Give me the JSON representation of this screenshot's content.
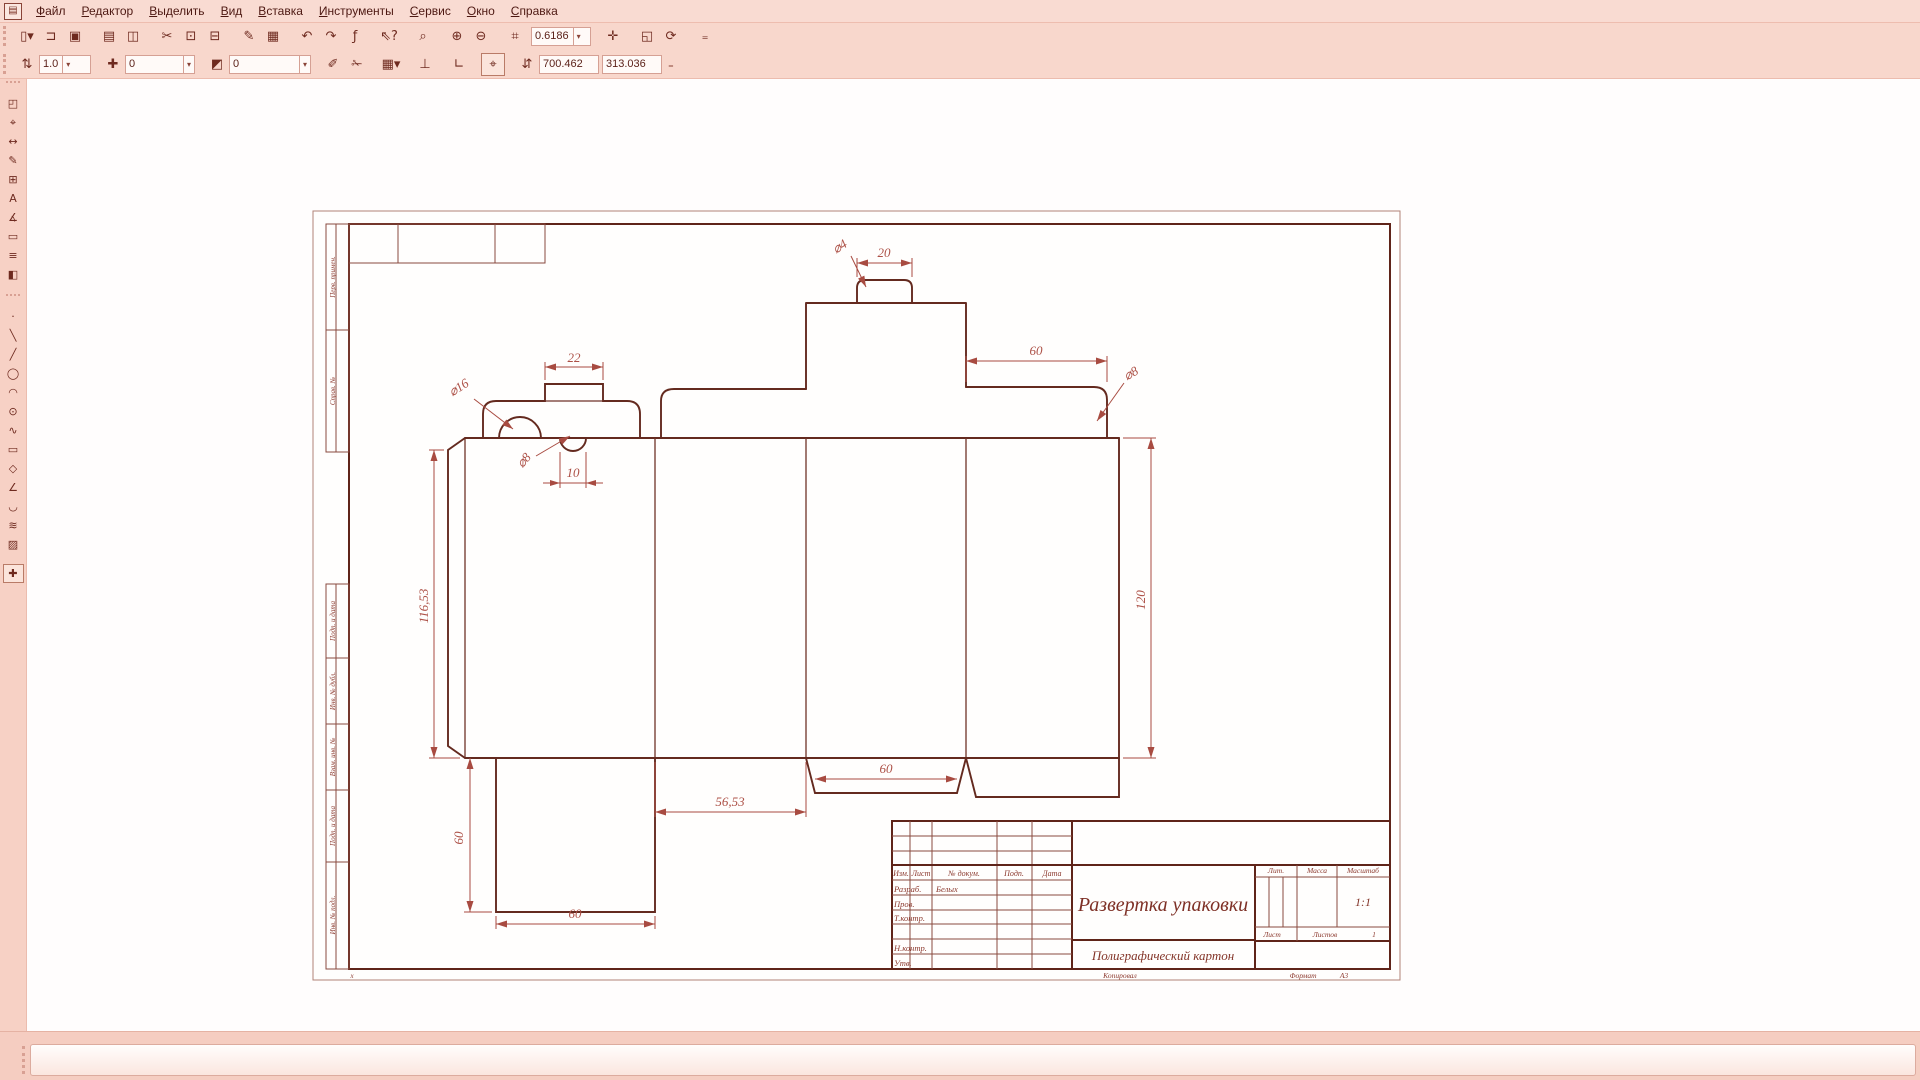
{
  "chrome": {
    "app_icon_glyph": "▤"
  },
  "menu": {
    "items": [
      {
        "name": "menu-file",
        "label": "Файл"
      },
      {
        "name": "menu-editor",
        "label": "Редактор"
      },
      {
        "name": "menu-select",
        "label": "Выделить"
      },
      {
        "name": "menu-view",
        "label": "Вид"
      },
      {
        "name": "menu-insert",
        "label": "Вставка"
      },
      {
        "name": "menu-tools",
        "label": "Инструменты"
      },
      {
        "name": "menu-service",
        "label": "Сервис"
      },
      {
        "name": "menu-window",
        "label": "Окно"
      },
      {
        "name": "menu-help",
        "label": "Справка"
      }
    ]
  },
  "toolbar_top": {
    "icons_left": [
      {
        "name": "new-document-icon",
        "glyph": "▯▾"
      },
      {
        "name": "open-icon",
        "glyph": "⊐"
      },
      {
        "name": "save-icon",
        "glyph": "▣"
      },
      {
        "name": "print-preview-icon",
        "glyph": "▤",
        "cls": "sep"
      },
      {
        "name": "page-layout-icon",
        "glyph": "◫"
      },
      {
        "name": "cut-icon",
        "glyph": "✂",
        "cls": "sep"
      },
      {
        "name": "copy-icon",
        "glyph": "⊡"
      },
      {
        "name": "paste-icon",
        "glyph": "⊟"
      },
      {
        "name": "copy-style-icon",
        "glyph": "✎",
        "cls": "sep"
      },
      {
        "name": "table-icon",
        "glyph": "▦"
      },
      {
        "name": "undo-icon",
        "glyph": "↶",
        "cls": "sep"
      },
      {
        "name": "redo-icon",
        "glyph": "↷"
      },
      {
        "name": "variables-icon",
        "glyph": "ƒ"
      },
      {
        "name": "context-help-icon",
        "glyph": "⇖?",
        "cls": "sep"
      },
      {
        "name": "zoom-selection-icon",
        "glyph": "⌕",
        "cls": "sep"
      },
      {
        "name": "zoom-in-icon",
        "glyph": "⊕",
        "cls": "sep"
      },
      {
        "name": "zoom-out-icon",
        "glyph": "⊖"
      },
      {
        "name": "zoom-area-icon",
        "glyph": "⌗",
        "cls": "sep"
      }
    ],
    "scale_value": "0.6186",
    "icons_right": [
      {
        "name": "pan-icon",
        "glyph": "✛",
        "cls": "sep"
      },
      {
        "name": "show-page-icon",
        "glyph": "◱",
        "cls": "sep"
      },
      {
        "name": "rebuild-view-icon",
        "glyph": "⟳"
      },
      {
        "name": "toolbar-overflow-icon",
        "glyph": "₌",
        "cls": "sep"
      }
    ]
  },
  "toolbar_params": {
    "line_style_icon": "⇅",
    "lineweight_value": "1.0",
    "layer_icon": "✚",
    "layer_value": "0",
    "style_icon": "◩",
    "style_value": "0",
    "icons": [
      {
        "name": "eraser-icon",
        "glyph": "✐",
        "cls": "sep"
      },
      {
        "name": "trim-icon",
        "glyph": "✁"
      },
      {
        "name": "grid-icon",
        "glyph": "▦▾",
        "cls": "sep"
      },
      {
        "name": "local-axes-icon",
        "glyph": "⊥",
        "cls": "sep"
      },
      {
        "name": "corner-snap-icon",
        "glyph": "∟",
        "cls": "sep"
      },
      {
        "name": "snap-settings-icon",
        "glyph": "⌖",
        "cls": "sep",
        "state": "active"
      }
    ],
    "coords_icon": "⇵",
    "x_value": "700.462",
    "y_value": "313.036",
    "overflow_glyph": "₌"
  },
  "left_toolbar": {
    "groups": [
      {
        "items": [
          {
            "name": "panel-properties",
            "glyph": "◰"
          },
          {
            "name": "panel-geometry",
            "glyph": "⌖"
          },
          {
            "name": "panel-dimensions",
            "glyph": "↔"
          },
          {
            "name": "panel-designations",
            "glyph": "✎"
          },
          {
            "name": "panel-editing",
            "glyph": "⊞"
          },
          {
            "name": "panel-parametrization",
            "glyph": "A"
          },
          {
            "name": "panel-measurement",
            "glyph": "∡"
          },
          {
            "name": "panel-selection",
            "glyph": "▭"
          },
          {
            "name": "panel-specification",
            "glyph": "≡"
          },
          {
            "name": "panel-reports",
            "glyph": "◧"
          }
        ]
      },
      {
        "items": [
          {
            "name": "point-tool",
            "glyph": "·"
          },
          {
            "name": "auxiliary-line-tool",
            "glyph": "╲"
          },
          {
            "name": "segment-tool",
            "glyph": "╱"
          },
          {
            "name": "circle-tool",
            "glyph": "◯"
          },
          {
            "name": "arc-tool",
            "glyph": "◠"
          },
          {
            "name": "ellipse-tool",
            "glyph": "⊙"
          },
          {
            "name": "spline-tool",
            "glyph": "∿"
          },
          {
            "name": "rectangle-tool",
            "glyph": "▭"
          },
          {
            "name": "polygon-tool",
            "glyph": "◇"
          },
          {
            "name": "chamfer-tool",
            "glyph": "∠"
          },
          {
            "name": "fillet-tool",
            "glyph": "◡"
          },
          {
            "name": "offset-tool",
            "glyph": "≋"
          },
          {
            "name": "hatch-tool",
            "glyph": "▨"
          }
        ]
      },
      {
        "items": [
          {
            "name": "continuous-input-tool",
            "glyph": "✚",
            "state": "active"
          }
        ]
      }
    ]
  },
  "drawing": {
    "frame_labels": [
      "Перв. примен.",
      "Справ. №",
      "Подп. и дата",
      "Инв. № дубл.",
      "Взам. инв. №",
      "Подп. и дата",
      "Инв. № подл."
    ],
    "origin_marker": "x",
    "dims": {
      "tab_width": "20",
      "tab_corner": "⌀4",
      "small_tab_width": "22",
      "notch_large": "⌀16",
      "notch_small": "⌀8",
      "notch_offset": "10",
      "top_flap_width": "60",
      "corner_right": "⌀8",
      "body_height": "120",
      "glue_flap_height": "116,53",
      "left_flap_height": "60",
      "panel_width": "56,53",
      "center_flap_width": "60",
      "left_flap_width": "60"
    },
    "title_block": {
      "header_cols": [
        "Изм.",
        "Лист",
        "№ докум.",
        "Подп.",
        "Дата"
      ],
      "rows": [
        {
          "role": "Разраб.",
          "name": "Белых"
        },
        {
          "role": "Пров.",
          "name": ""
        },
        {
          "role": "Т.контр.",
          "name": ""
        },
        {
          "role": "Н.контр.",
          "name": ""
        },
        {
          "role": "Утв.",
          "name": ""
        }
      ],
      "title": "Развертка упаковки",
      "material": "Полиграфический картон",
      "lit_label": "Лит.",
      "mass_label": "Масса",
      "scale_label": "Масштаб",
      "scale_value": "1:1",
      "sheet_label": "Лист",
      "sheets_label": "Листов",
      "sheets_value": "1",
      "copied_label": "Копировал",
      "format_label": "Формат",
      "format_value": "A3"
    }
  }
}
